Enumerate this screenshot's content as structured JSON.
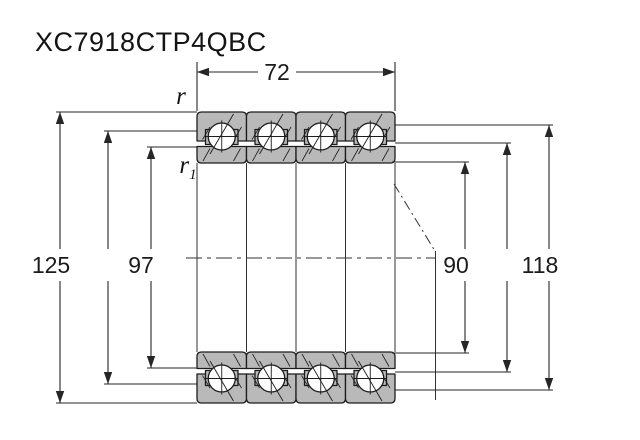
{
  "title": "XC7918CTP4QBC",
  "dims": {
    "width": "72",
    "outer_diameter": "125",
    "left_shoulder_diameter": "97",
    "bore_diameter": "90",
    "right_shoulder_diameter": "118"
  },
  "chamfers": {
    "r": "r",
    "r1_base": "r",
    "r1_sub": "1"
  },
  "colors": {
    "ring_fill": "#b9b9b9",
    "outline": "#1c1c1c",
    "background": "#ffffff"
  }
}
